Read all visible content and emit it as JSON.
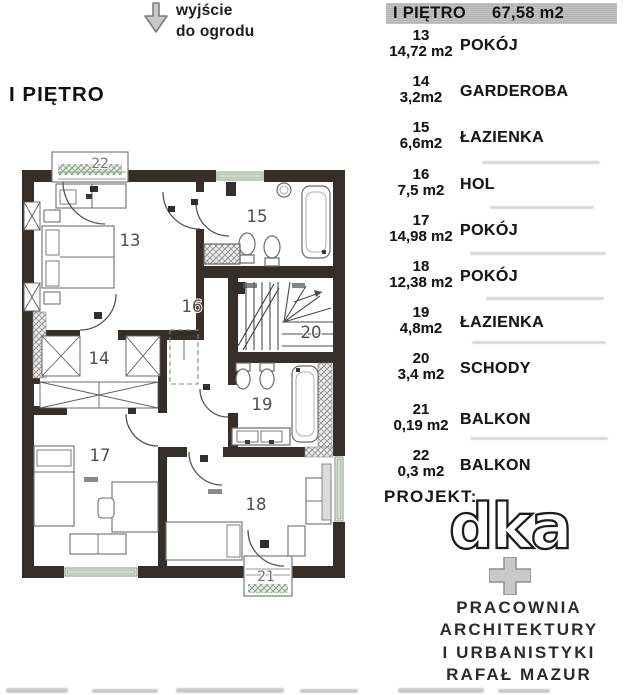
{
  "top_note": {
    "line1": "wyjście",
    "line2": "do ogrodu"
  },
  "plan": {
    "title": "I PIĘTRO",
    "labels": [
      "13",
      "14",
      "15",
      "16",
      "17",
      "18",
      "19",
      "20",
      "21",
      "22"
    ]
  },
  "legend": {
    "header": {
      "title": "I PIĘTRO",
      "area": "67,58 m2"
    },
    "rows": [
      {
        "no": "13",
        "area": "14,72 m2",
        "name": "POKÓJ"
      },
      {
        "no": "14",
        "area": "3,2m2",
        "name": "GARDEROBA"
      },
      {
        "no": "15",
        "area": "6,6m2",
        "name": "ŁAZIENKA"
      },
      {
        "no": "16",
        "area": "7,5 m2",
        "name": "HOL"
      },
      {
        "no": "17",
        "area": "14,98 m2",
        "name": "POKÓJ"
      },
      {
        "no": "18",
        "area": "12,38 m2",
        "name": "POKÓJ"
      },
      {
        "no": "19",
        "area": "4,8m2",
        "name": "ŁAZIENKA"
      },
      {
        "no": "20",
        "area": "3,4 m2",
        "name": "SCHODY"
      },
      {
        "no": "21",
        "area": "0,19 m2",
        "name": "BALKON"
      },
      {
        "no": "22",
        "area": "0,3 m2",
        "name": "BALKON"
      }
    ]
  },
  "project": {
    "label": "PROJEKT:",
    "logo": "dka",
    "studio_lines": [
      "PRACOWNIA",
      "ARCHITEKTURY",
      "I URBANISTYKI",
      "RAFAŁ MAZUR"
    ]
  },
  "colors": {
    "wall": "#362e29",
    "window_green": "#cfe0c9",
    "header_bg": "#bcbcbc",
    "logo_outline": "#1a1a1a"
  }
}
